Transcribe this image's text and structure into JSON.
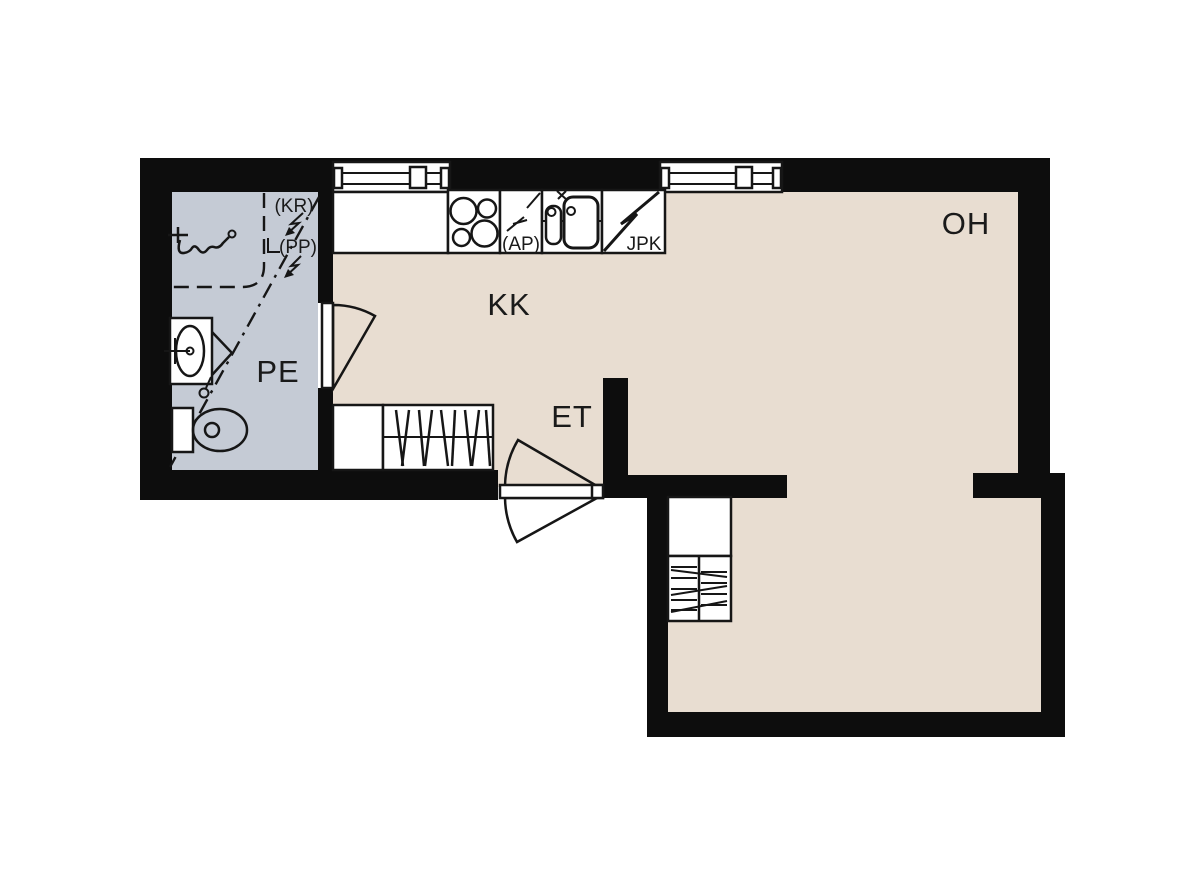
{
  "plan": {
    "title": "apartment-floor-plan",
    "rooms": [
      {
        "id": "oh",
        "label": "OH"
      },
      {
        "id": "kk",
        "label": "KK"
      },
      {
        "id": "pe",
        "label": "PE"
      },
      {
        "id": "et",
        "label": "ET"
      }
    ],
    "appliances": {
      "jpk_label": "JPK",
      "ap_label": "(AP)",
      "kr_label": "(KR)",
      "pp_label": "(PP)"
    },
    "colors": {
      "wall": "#0d0d0d",
      "line": "#161616",
      "floor_main": "#e8ddd1",
      "floor_bathroom": "#c5cbd5",
      "background": "#ffffff"
    }
  }
}
